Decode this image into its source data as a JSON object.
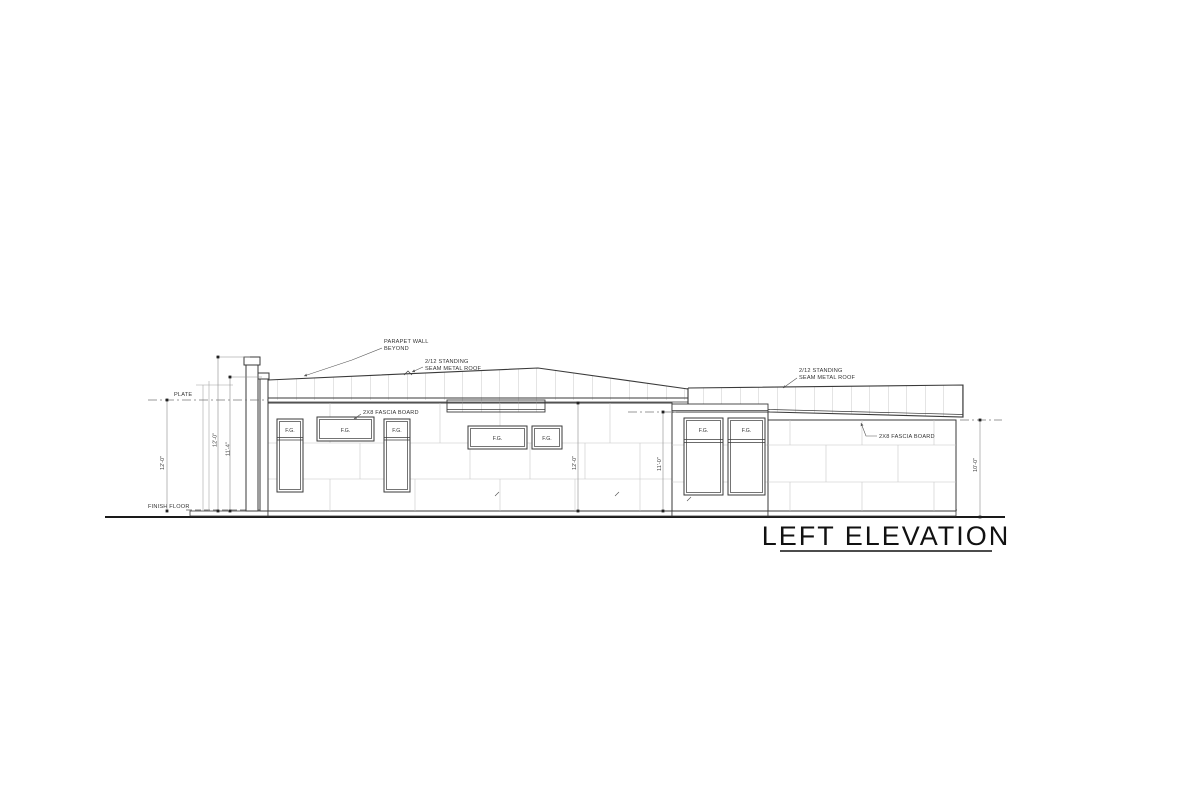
{
  "title": {
    "text": "LEFT ELEVATION"
  },
  "labels": {
    "plate": "PLATE",
    "finish_floor": "FINISH FLOOR"
  },
  "annotations": {
    "parapet_line1": "PARAPET WALL",
    "parapet_line2": "BEYOND",
    "roof_left_line1": "2/12 STANDING",
    "roof_left_line2": "SEAM METAL ROOF",
    "roof_right_line1": "2/12 STANDING",
    "roof_right_line2": "SEAM METAL ROOF",
    "fascia_left": "2X8 FASCIA BOARD",
    "fascia_right": "2X8 FASCIA BOARD"
  },
  "dimensions": {
    "plate_height": "12'-0\"",
    "parapet_tall": "12'-0\"",
    "parapet_low": "11'-4\"",
    "mid_wall": "12'-0\"",
    "mid_right_wall": "11'-0\"",
    "right_wall": "10'-0\""
  },
  "windows": {
    "labels": [
      "F.G.",
      "F.G.",
      "F.G.",
      "F.G.",
      "F.G.",
      "F.G.",
      "F.G."
    ]
  },
  "colors": {
    "line": "#3a3a3a",
    "grid": "#c4c4c4",
    "dim": "#8a8a8a",
    "seam": "#9a9a9a",
    "text": "#333333",
    "title": "#111111"
  }
}
